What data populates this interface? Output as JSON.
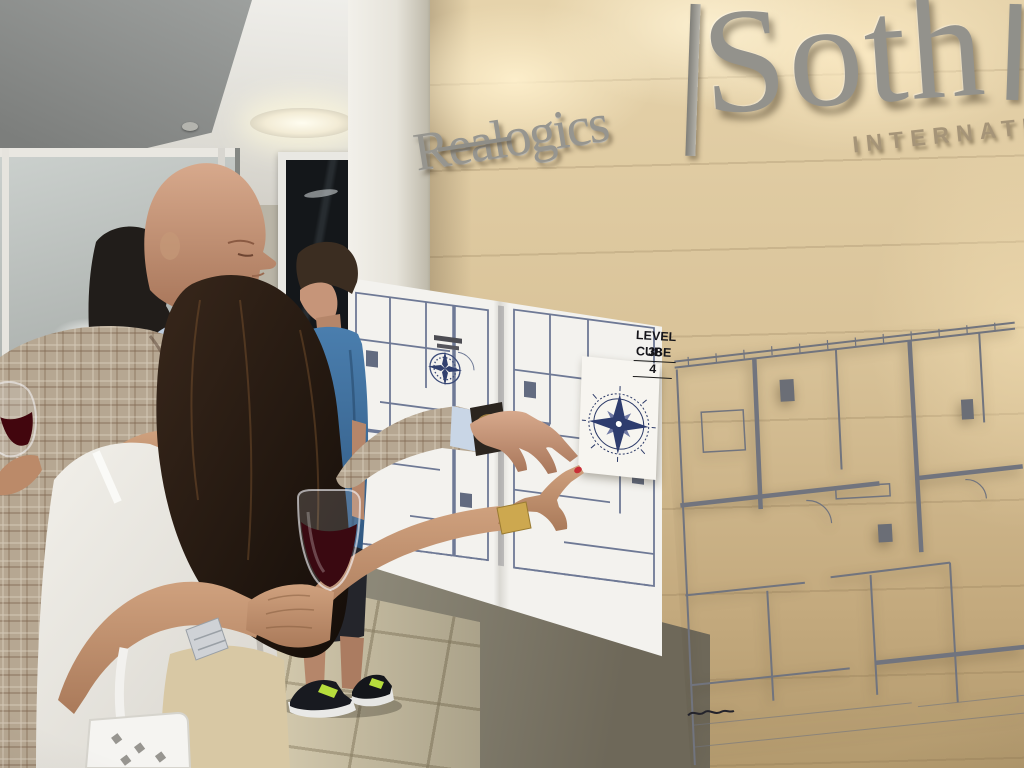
{
  "scene": {
    "description": "Guests examining high-rise floor plans on a limestone wall at a Realogics Sotheby's office event",
    "signage": {
      "left_brand": "Realogics",
      "right_brand_partial": "Soth",
      "right_subtitle_partial": "INTERNATIO"
    },
    "plan_label": {
      "line1": "LEVEL 38",
      "line2": "CUBE 4"
    },
    "icons": {
      "large_compass": "compass-rose-icon",
      "small_compass": "compass-rose-icon"
    },
    "colors": {
      "limestone_wall": "#d9c399",
      "sign_letters": "#93928c",
      "plan_lines_left": "#6e7995",
      "plan_lines_right": "#71747e",
      "compass_navy": "#2e3c6e",
      "wine": "#3a0911",
      "blazer_plaid": "#b6a792",
      "dress_shirt_blue": "#bccbdd",
      "tee_blue": "#3f74a6",
      "white_top": "#ebe9e4",
      "nail_red": "#c92f36",
      "sneaker_accent": "#b6dd3c",
      "floor_tile": "#d5cbaf"
    }
  }
}
